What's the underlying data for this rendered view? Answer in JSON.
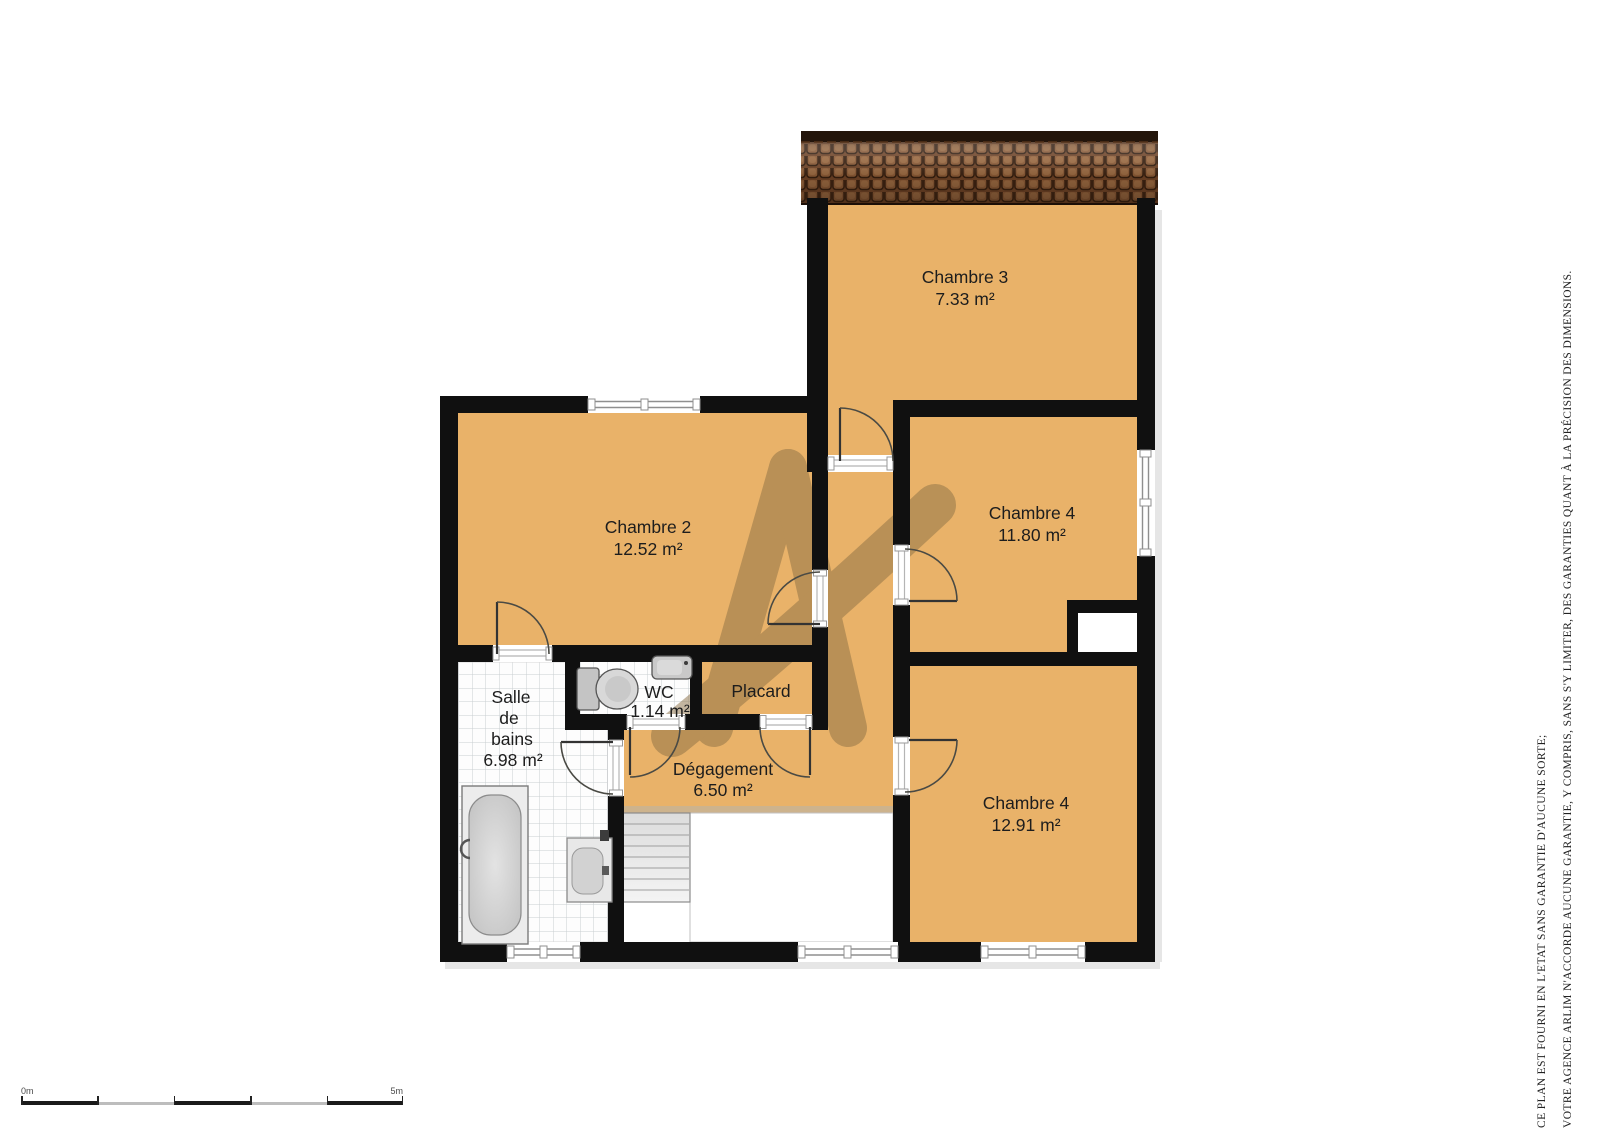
{
  "watermark": {
    "letter": "A",
    "color": "#8a6f45"
  },
  "rooms": [
    {
      "id": "chambre3",
      "name": "Chambre 3",
      "area": "7.33 m²"
    },
    {
      "id": "chambre2",
      "name": "Chambre 2",
      "area": "12.52 m²"
    },
    {
      "id": "chambre4a",
      "name": "Chambre 4",
      "area": "11.80 m²"
    },
    {
      "id": "chambre4b",
      "name": "Chambre 4",
      "area": "12.91 m²"
    },
    {
      "id": "salle_de_bains",
      "name_lines": [
        "Salle",
        "de",
        "bains"
      ],
      "area": "6.98 m²"
    },
    {
      "id": "wc",
      "name": "WC",
      "area": "1.14 m²"
    },
    {
      "id": "placard",
      "name": "Placard"
    },
    {
      "id": "degagement",
      "name": "Dégagement",
      "area": "6.50 m²"
    }
  ],
  "scale_bar": {
    "start_label": "0m",
    "end_label": "5m"
  },
  "disclaimer": {
    "line1": "CE PLAN EST FOURNI EN L'ETAT SANS GARANTIE D'AUCUNE SORTE;",
    "line2": "VOTRE AGENCE ARLIM N'ACCORDE AUCUNE GARANTIE, Y COMPRIS, SANS S'Y LIMITER, DES GARANTIES QUANT À LA PRÉCISION DES DIMENSIONS."
  },
  "colors": {
    "floor_orange": "#e9b269",
    "wall": "#101010",
    "roof_brown": "#7f5130",
    "degagement_shadow": "#cdb38d"
  }
}
